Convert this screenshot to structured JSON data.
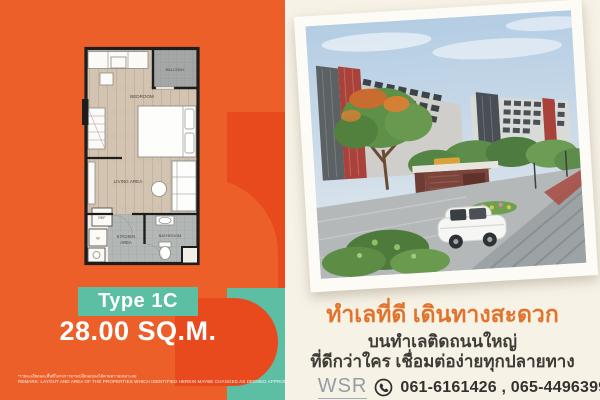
{
  "left_panel": {
    "colors": {
      "background": "#EC5F28",
      "accent_dark": "#E8491D",
      "teal": "#5CBEA3"
    },
    "floorplan": {
      "labels": {
        "balcony": "BALCONY",
        "bedroom": "BEDROOM",
        "living": "LIVING AREA",
        "ref": "REF",
        "washer": "W",
        "kitchen_line1": "KITCHEN",
        "kitchen_line2": "AREA",
        "bathroom": "BATHROOM"
      }
    },
    "type_badge": "Type 1C",
    "area": "28.00 SQ.M.",
    "disclaimer_th": "*รายละเอียดและพื้นที่โครงการอาจเปลี่ยนแปลงได้ตามความเหมาะสม",
    "disclaimer_en": "REMARK: LAYOUT AND AREA OF THE PROPERTIES WHICH IDENTIFIED HEREIN MAYBE CHANGED AS DEEMED APPROPRIATE,BUT WILL NOT IMPACT UPON THE USE"
  },
  "right_panel": {
    "colors": {
      "background": "#F7F2E6",
      "headline": "#E2732D",
      "body_text": "#3F3B37"
    },
    "headline": "ทำเลที่ดี เดินทางสะดวก",
    "subline1": "บนทำเลติดถนนใหญ่",
    "subline2": "ที่ดีกว่าใคร เชื่อมต่อง่ายทุกปลายทาง",
    "contact": {
      "brand": "WSR",
      "phone_icon": "phone-circle-icon",
      "phones": "061-6161426 , 065-4496399"
    }
  }
}
